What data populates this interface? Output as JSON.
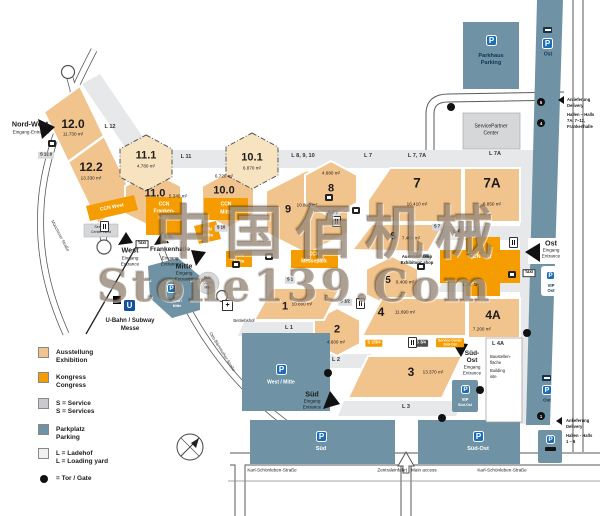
{
  "watermark": {
    "line1": "中国佰机械",
    "line2": "Stone139.Com"
  },
  "colors": {
    "exhibition": "#f2c48d",
    "exhibition_planned": "#f8e3c0",
    "congress": "#f59c00",
    "service_gray": "#c9cacd",
    "parking_blue": "#6f93a5",
    "loading_gray": "#e7e8ea",
    "p_badge_blue": "#1c6eb6",
    "ubahn_blue": "#1450a0"
  },
  "halls": {
    "h12_0": {
      "id": "12.0",
      "area": "11.730 m²"
    },
    "h12_2": {
      "id": "12.2",
      "area": "13.330 m²"
    },
    "h11_1": {
      "id": "11.1",
      "area": "4.780 m²"
    },
    "h11_0": {
      "id": "11.0",
      "area": "5.340 m²"
    },
    "h10_1": {
      "id": "10.1",
      "area": "6.870 m²"
    },
    "h10_0": {
      "id": "10.0",
      "area": "6.720 m²"
    },
    "h9": {
      "id": "9",
      "area": "10.800 m²"
    },
    "h8": {
      "id": "8",
      "area": "4.680 m²"
    },
    "h7": {
      "id": "7",
      "area": "16.410 m²"
    },
    "h7a": {
      "id": "7A",
      "area": "8.850 m²"
    },
    "h6": {
      "id": "6",
      "area": "7.400 m²"
    },
    "h5": {
      "id": "5",
      "area": "8.400 m²"
    },
    "h4": {
      "id": "4",
      "area": "11.690 m²"
    },
    "h4a": {
      "id": "4A",
      "area": "7.200 m²"
    },
    "h3": {
      "id": "3",
      "area": "13.370 m²"
    },
    "h2": {
      "id": "2",
      "area": "4.600 m²"
    },
    "h1": {
      "id": "1",
      "area": "10.800 m²"
    }
  },
  "ccn": {
    "west": "CCN West",
    "frankenhalle": {
      "l1": "CCN",
      "l2": "Franken-",
      "l3": "halle"
    },
    "mitte_upper": {
      "l1": "CCN",
      "l2": "Mitte"
    },
    "mitte_a": {
      "l1": "CCN",
      "l2": "Mitte"
    },
    "mitte_b": {
      "l1": "CCN",
      "l2": "Mitte"
    },
    "messepark": {
      "l1": "CCN",
      "l2": "Messepark"
    },
    "ost": "CCN Ost"
  },
  "loading_yards": {
    "l12": "L 12",
    "l11": "L 11",
    "l8_9_10": "L 8, 9, 10",
    "l7": "L 7",
    "l7_7a": "L 7, 7A",
    "l7a": "L 7A",
    "l6": "L 6",
    "l4_5": "L 4, 5",
    "l4a": "L 4A",
    "l3": "L 3",
    "l2": "L 2",
    "l1": "L 1"
  },
  "services": {
    "s12_0": "S 12.0",
    "s11": "S 11",
    "s10": "S 10",
    "s8_9": "S 8/9",
    "s7": "S 7",
    "s5_6": "S 5/6",
    "s1_2": "S 1/2",
    "s1": "S 1",
    "s2_3_4": "S 2/3/4",
    "s3_4": "S 3/4",
    "center_west": {
      "l1": "Service-",
      "l2": "Center West"
    },
    "center_mitte": {
      "l1": "Serv.-",
      "l2": "Center",
      "l3": "Mitte"
    },
    "center_sued_ost": {
      "l1": "Service-Center",
      "l2": "Süd-Ost"
    },
    "service_partner": {
      "l1": "ServicePartner",
      "l2": "Center"
    },
    "exhibitors_shop": {
      "l1": "Ausstellershop",
      "l2": "Exhibitors' shop"
    }
  },
  "entrances": {
    "nord_west": {
      "name": "Nord-West",
      "sub": "Eingang·Entrance"
    },
    "west": {
      "name": "West",
      "l1": "Eingang",
      "l2": "Entrance"
    },
    "frankenhalle": {
      "name": "Frankenhalle",
      "l1": "Eingang",
      "l2": "Entrance"
    },
    "mitte": {
      "name": "Mitte",
      "l1": "Eingang",
      "l2": "Entrance"
    },
    "ost": {
      "name": "Ost",
      "l1": "Eingang",
      "l2": "Entrance"
    },
    "sued": {
      "name": "Süd",
      "l1": "Eingang",
      "l2": "Entrance"
    },
    "sued_ost": {
      "name1": "Süd-",
      "name2": "Ost",
      "l1": "Eingang",
      "l2": "Entrance"
    }
  },
  "parking": {
    "p_letter": "P",
    "parkhaus": {
      "l1": "Parkhaus",
      "l2": "Parking"
    },
    "ost_top": "Ost",
    "ost_mid": "Ost",
    "vip_ost": {
      "l1": "VIP",
      "l2": "Ost"
    },
    "vip_west_mitte": {
      "l1": "VIP",
      "l2": "West /",
      "l3": "Mitte"
    },
    "vip_sued_ost": {
      "l1": "VIP",
      "l2": "Süd-Ost"
    },
    "west_mitte": "West / Mitte",
    "sued": "Süd",
    "sued_ost": "Süd-Ost"
  },
  "transit": {
    "u_letter": "U",
    "ubahn": "U-Bahn / Subway",
    "station": "Messe",
    "taxi": "TAXI"
  },
  "delivery": {
    "top": {
      "l1": "Anlieferung",
      "l2": "Delivery",
      "l3": "Hallen – Halls",
      "l4": "7A, 7–12,",
      "l5": "Frankenhalle"
    },
    "bottom": {
      "l1": "Anlieferung",
      "l2": "Delivery",
      "l3": "Hallen - Halls",
      "l4": "1 – 6"
    }
  },
  "streets": {
    "muenchener": "Münchener Straße",
    "otto_baernreuther": "Otto-Bärnreuther-Straße",
    "karl_schoenleben_left": "Karl-Schönleben-Straße",
    "zentraleinfahrt": "Zentraleinfahrt · Main access",
    "karl_schoenleben_right": "Karl-Schönleben-Straße"
  },
  "legend": {
    "exhibition": {
      "de": "Ausstellung",
      "en": "Exhibition"
    },
    "congress": {
      "de": "Kongress",
      "en": "Congress"
    },
    "service": {
      "de": "S = Service",
      "en": "S = Services"
    },
    "parking": {
      "de": "Parkplatz",
      "en": "Parking"
    },
    "loading": {
      "de": "L = Ladehof",
      "en": "L = Loading yard"
    },
    "gate": {
      "de": "= Tor / Gate"
    }
  },
  "gates": {
    "g5": "5",
    "g4": "4",
    "g1": "1"
  },
  "misc": {
    "betriebshof": "Betriebshof",
    "building_site": {
      "l1": "Baustellen-",
      "l2": "fläche",
      "l3": "Building",
      "l4": "site"
    }
  }
}
